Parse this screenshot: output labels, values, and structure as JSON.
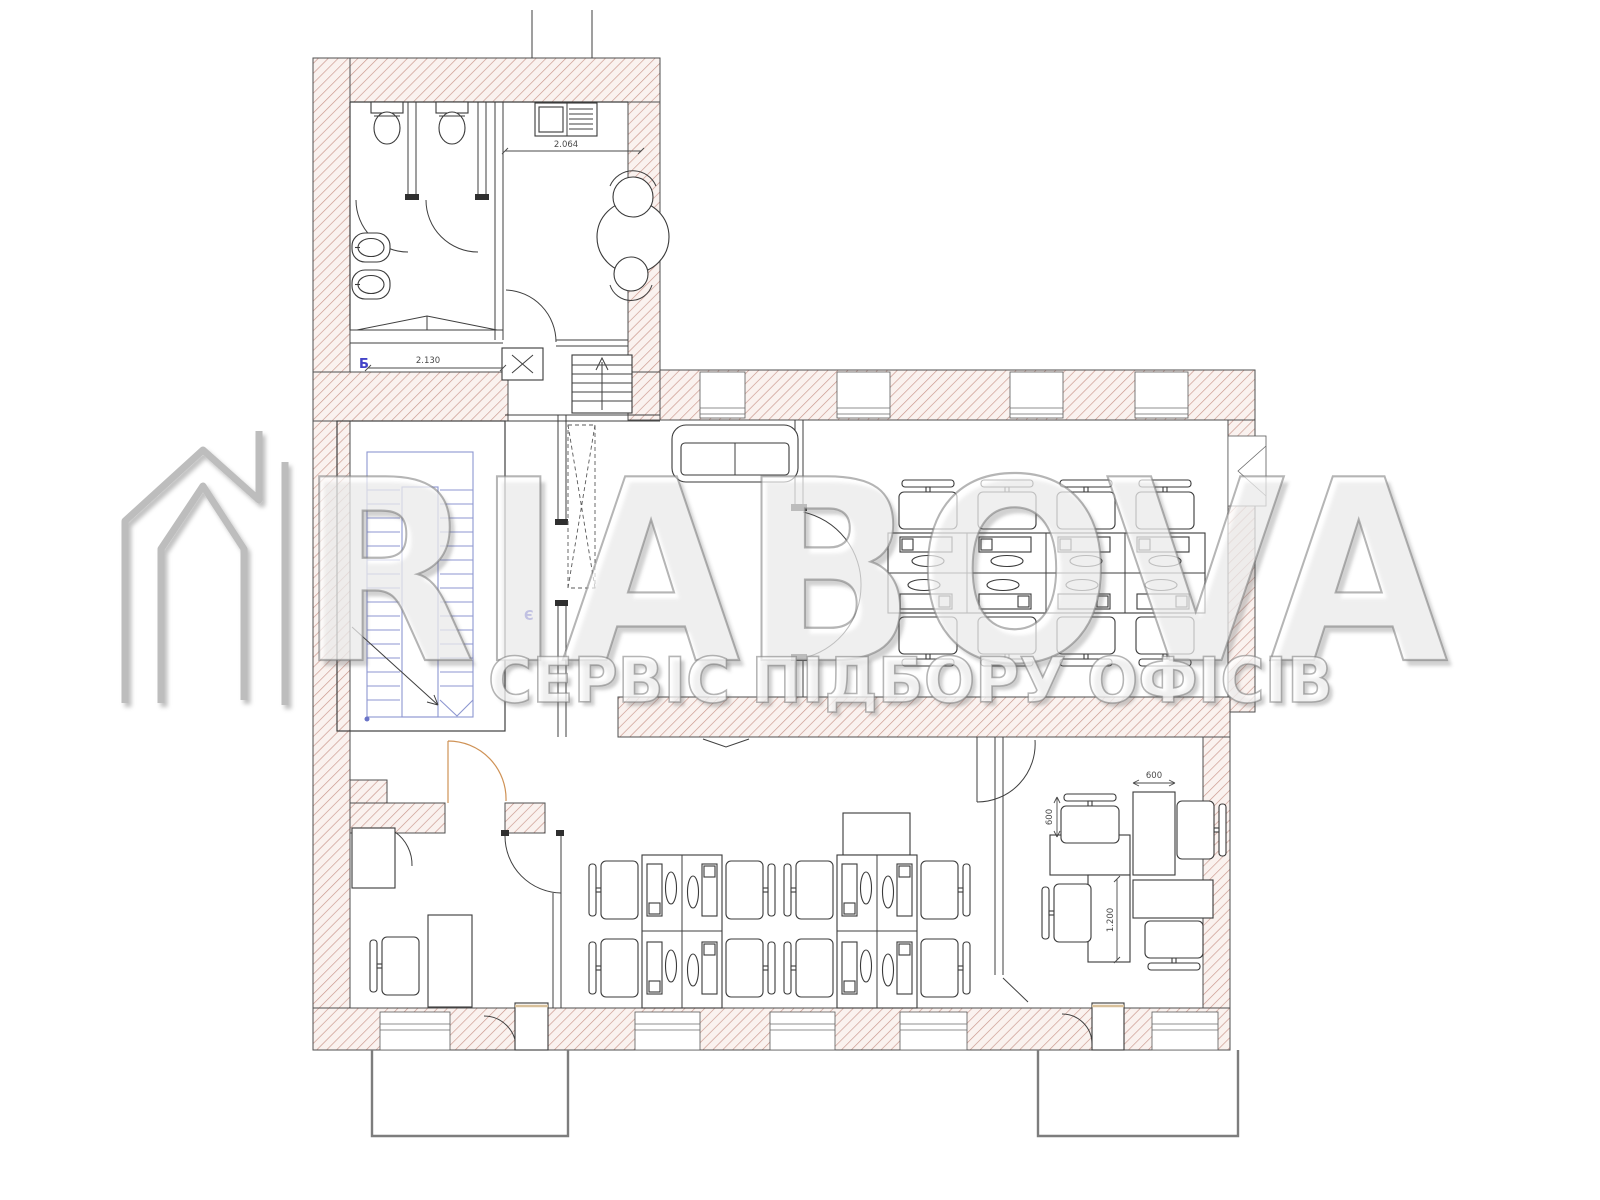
{
  "watermark": {
    "brand": "RIABOVA",
    "tagline": "СЕРВІС ПІДБОРУ ОФІСІВ"
  },
  "markers": {
    "section": "Б",
    "level": "Є"
  },
  "dimensions": {
    "toilet_block_width": "2.130",
    "kitchen_unit_width": "2.064",
    "desk_width_top": "600",
    "desk_width_left": "600",
    "desk_length": "1.200"
  },
  "palette": {
    "wall_hatch_line": "#c9968b",
    "wall_hatch_bg": "#faf2ef",
    "plan_line": "#3f3f3f",
    "stair_line": "#8d96d0",
    "marker_blue": "#4343c8",
    "door_accent": "#cf9256",
    "balcony_line": "#7d7d7d",
    "watermark_gray": "#bdbdbd"
  }
}
